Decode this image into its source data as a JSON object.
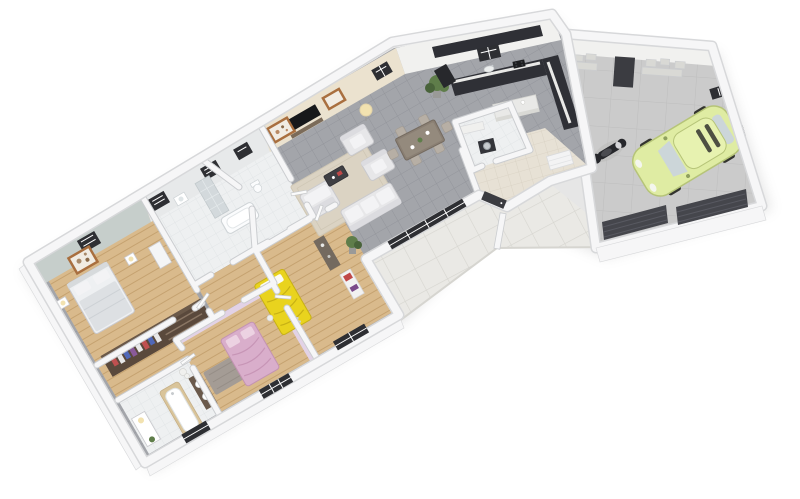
{
  "scene": {
    "type": "3d-isometric-floorplan-render",
    "rooms": [
      {
        "id": "master-bedroom",
        "floor": "wood"
      },
      {
        "id": "bathroom",
        "floor": "white-tile"
      },
      {
        "id": "hallway",
        "floor": "wood"
      },
      {
        "id": "walk-in-closet",
        "floor": "wood"
      },
      {
        "id": "family-bathroom",
        "floor": "white-tile"
      },
      {
        "id": "bedroom-pink",
        "floor": "wood"
      },
      {
        "id": "bedroom-kids",
        "floor": "wood"
      },
      {
        "id": "living-dining-room",
        "floor": "grey-tile"
      },
      {
        "id": "kitchen",
        "floor": "grey-tile"
      },
      {
        "id": "laundry",
        "floor": "white-tile"
      },
      {
        "id": "entry-hall",
        "floor": "beige-tile"
      },
      {
        "id": "terrace",
        "floor": "large-white-tile"
      },
      {
        "id": "garage",
        "floor": "concrete"
      }
    ],
    "vehicles": [
      {
        "id": "city-car",
        "color": "pale-green"
      },
      {
        "id": "scooter",
        "color": "black"
      }
    ],
    "furniture": [
      "double-bed",
      "pink-bed",
      "yellow-bed",
      "corner-sofa",
      "armchairs",
      "coffee-table",
      "tv",
      "picture-frames",
      "dining-table",
      "dining-chairs",
      "kitchen-counter",
      "kitchen-island",
      "bathtub",
      "shower",
      "toilet",
      "washbasin",
      "double-vanity",
      "wardrobe",
      "washing-machine",
      "desk",
      "wall-shelves",
      "plants",
      "floor-lamp"
    ]
  },
  "palette": {
    "bg": "#ffffff",
    "shadow": "#c8c8c8",
    "wallFill": "#f6f6f7",
    "wallEdge": "#cbcdd0",
    "wallOuterEdge": "#d7d8da",
    "masterWall": "#c6cecb",
    "bathWall": "#e7e9ea",
    "livingWall": "#ebe2cf",
    "kitchenWall": "#f1f1ef",
    "lilacWall": "#e2d2e6",
    "woodFloor": "#d9ba8c",
    "woodLine": "#c5a270",
    "tileFloor": "#a3a5aa",
    "tileLine": "#93959b",
    "bathFloor": "#eef0f1",
    "bathLine": "#dee2e4",
    "entryFloor": "#e7e1d5",
    "entryLine": "#d7d0c1",
    "terraceFloor": "#eae9e5",
    "terraceLine": "#d6d5d0",
    "concrete": "#cbcbcb",
    "concreteLine": "#bebebe",
    "windowDark": "#2e2f33",
    "windowLite": "#f4f5f6",
    "doorDark": "#3b3c41",
    "garageDoor": "#45464c",
    "garageDoorLine": "#585961",
    "counterDark": "#2f3036",
    "counterTop": "#e9e9e7",
    "sofa": "#e7e7e9",
    "sofaEdge": "#c9c9cd",
    "cushion": "#f3f3f5",
    "rugLiving": "#dbd3c3",
    "rugLivingEdge": "#cfc7b5",
    "rugBedroom": "#a49c95",
    "tableWood": "#8a7f73",
    "tableWoodDark": "#746a5f",
    "chair": "#b7afa5",
    "tvBlack": "#17181a",
    "frameWood": "#a96f3f",
    "frameInner": "#f1ece3",
    "bedWhite": "#eef0f2",
    "bedShadow": "#dde0e3",
    "bedPink": "#d9aecb",
    "bedPinkDeep": "#c795b6",
    "bedYellow": "#e9d31e",
    "bedYellowDeep": "#c7b115",
    "wardrobe": "#5a493c",
    "wardrobeDark": "#6b5949",
    "clothesRed": "#c05050",
    "clothesBlue": "#5068b8",
    "clothesWhite": "#e8e8e8",
    "clothesPurple": "#8a5a9a",
    "fixtureWhite": "#fbfcfd",
    "fixtureEdge": "#ced3d6",
    "showerTile": "#d3d9dc",
    "vanityDark": "#6a594b",
    "tubWood": "#d9c49a",
    "carBody": "#dfeca3",
    "carEdge": "#b6c478",
    "carGlass": "#ccd6d9",
    "carRoof": "#e7f2b0",
    "carDark": "#33342f",
    "scooterDark": "#26272b",
    "scooterLite": "#e9e9eb",
    "plantGreen": "#5f7d4a",
    "plantDark": "#49633a",
    "potGrey": "#9a9a98",
    "lampWarm": "#f2e2b0",
    "shelfBox": "#d9d9d5",
    "boxRed": "#c04848",
    "boxPurple": "#7a4a8a",
    "washerDark": "#34353a",
    "steel": "#c7cbce",
    "white": "#ffffff"
  }
}
